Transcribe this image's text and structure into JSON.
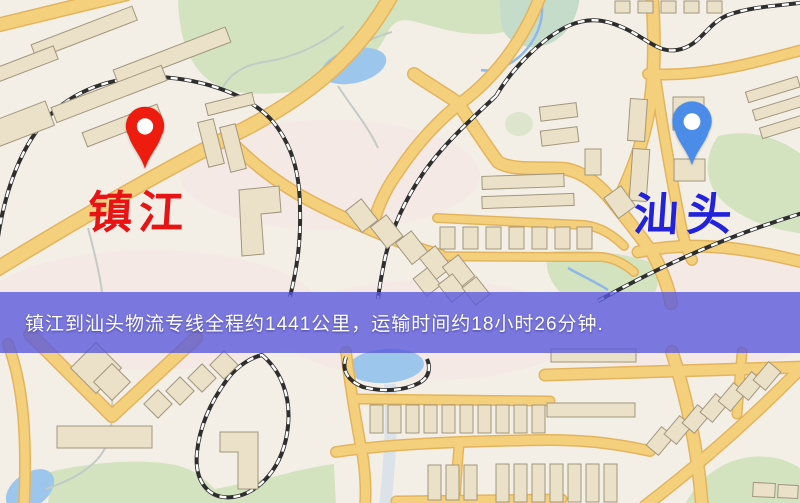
{
  "banner": {
    "text": "镇江到汕头物流专线全程约1441公里，运输时间约18小时26分钟.",
    "origin": "镇江",
    "destination": "汕头",
    "distance_text": "约1441公里",
    "duration_text": "约18小时26分钟"
  },
  "map": {
    "origin_marker": {
      "label": "镇江",
      "pin": "red-pin"
    },
    "destination_marker": {
      "label": "汕头",
      "pin": "blue-pin"
    }
  },
  "colors": {
    "banner-bg": "rgba(87,87,222,0.78)",
    "banner-text": "#ffffff",
    "origin-label": "#e81414",
    "destination-label": "#2222dc",
    "pin-red": "#ee1c0f",
    "pin-blue": "#4a8ce8",
    "map-bg": "#f4efe6",
    "road-fill": "#f5d07c",
    "road-casing": "#e3b45e",
    "park": "#d3e3c0",
    "water": "#9dc6ec",
    "building": "#eae1c8",
    "building-outline": "#a2967e",
    "rail": "#2e2e2e"
  }
}
